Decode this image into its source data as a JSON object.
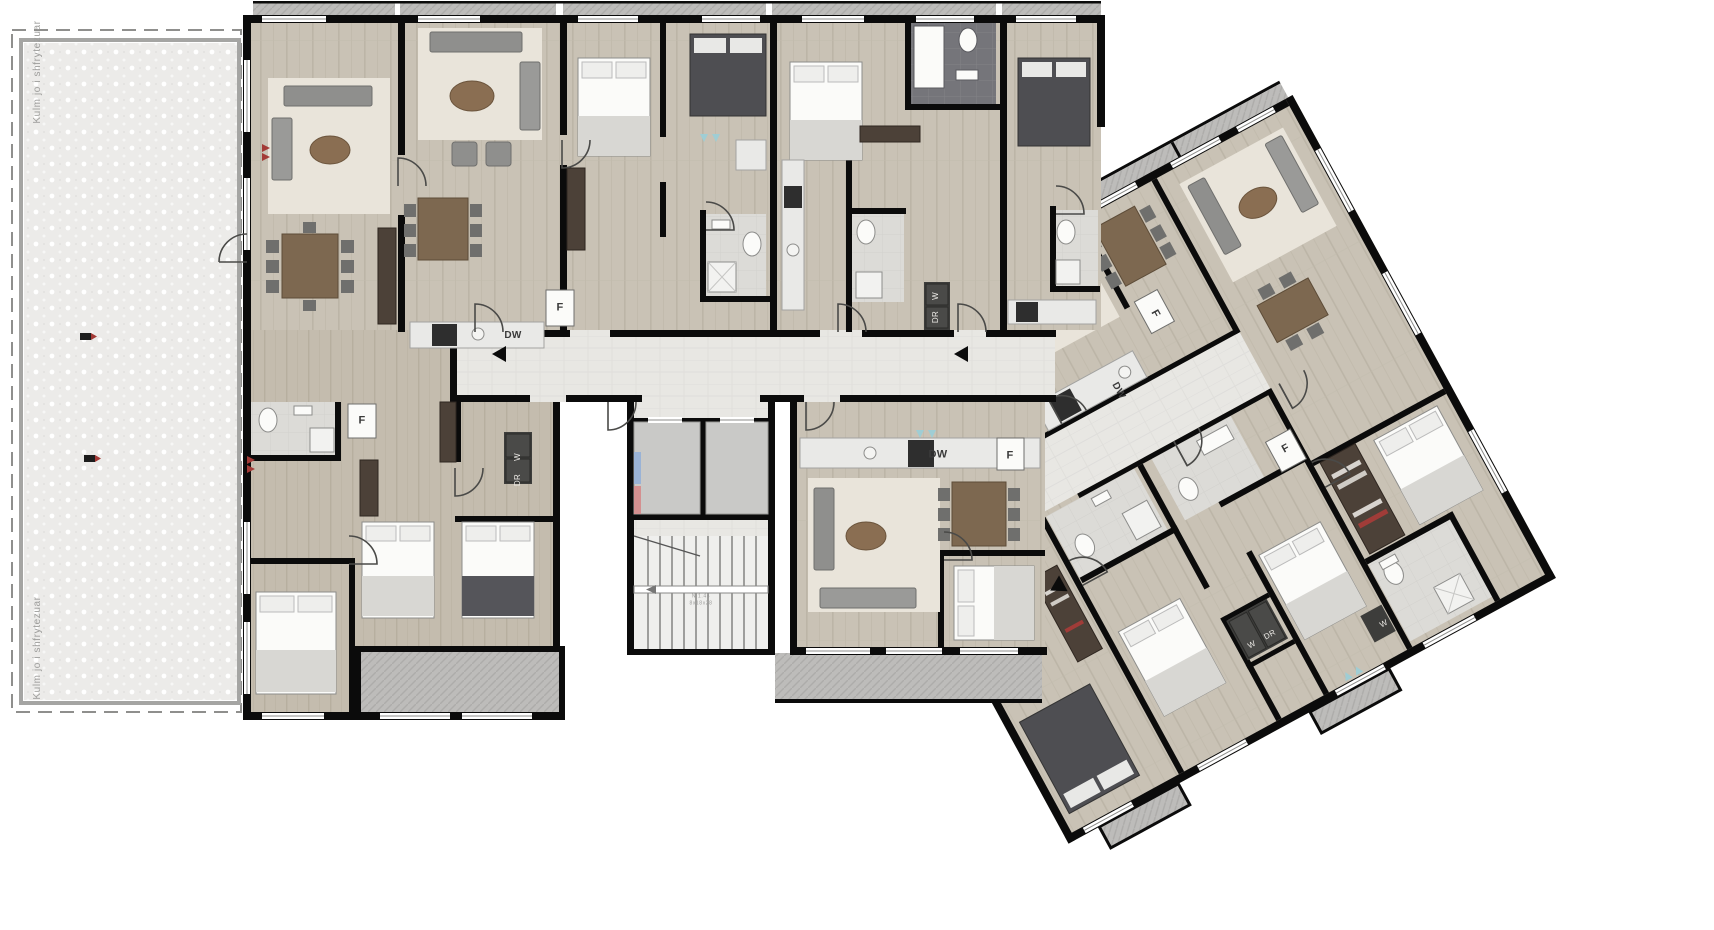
{
  "document": {
    "type": "architectural-floor-plan",
    "view": "furnished apartment level plan"
  },
  "terrace": {
    "label_top": "Kulm jo i shfrytezuar",
    "label_bottom": "Kulm jo i shfrytezuar"
  },
  "stairs": {
    "label_line1": "N 1.44",
    "label_line2": "8x18x28"
  },
  "legend": {
    "fridge": "F",
    "dishwasher": "DW",
    "washer": "W",
    "dryer": "DR"
  },
  "labels": [
    {
      "name": "terrace-label-top",
      "text": "Kulm jo i shfrytezuar",
      "x": 38,
      "y": 72,
      "rot": -90,
      "theme": "gray",
      "size": 10
    },
    {
      "name": "terrace-label-bottom",
      "text": "Kulm jo i shfrytezuar",
      "x": 38,
      "y": 648,
      "rot": -90,
      "theme": "gray",
      "size": 10
    },
    {
      "name": "fridge-label",
      "text": "F",
      "x": 560,
      "y": 308,
      "rot": 0,
      "theme": "",
      "size": 11
    },
    {
      "name": "dishwasher-label",
      "text": "DW",
      "x": 513,
      "y": 336,
      "rot": 0,
      "theme": "",
      "size": 10
    },
    {
      "name": "washer-label",
      "text": "W",
      "x": 936,
      "y": 296,
      "rot": -90,
      "theme": "light",
      "size": 8
    },
    {
      "name": "dryer-label",
      "text": "DR",
      "x": 936,
      "y": 317,
      "rot": -90,
      "theme": "light",
      "size": 8
    },
    {
      "name": "fridge-label",
      "text": "F",
      "x": 362,
      "y": 421,
      "rot": 0,
      "theme": "",
      "size": 11
    },
    {
      "name": "washer-label",
      "text": "W",
      "x": 518,
      "y": 457,
      "rot": -90,
      "theme": "light",
      "size": 8
    },
    {
      "name": "dryer-label",
      "text": "DR",
      "x": 518,
      "y": 480,
      "rot": -90,
      "theme": "light",
      "size": 8
    },
    {
      "name": "dishwasher-label",
      "text": "DW",
      "x": 938,
      "y": 455,
      "rot": 0,
      "theme": "",
      "size": 11
    },
    {
      "name": "fridge-label",
      "text": "F",
      "x": 1010,
      "y": 456,
      "rot": 0,
      "theme": "",
      "size": 11
    },
    {
      "name": "fridge-label",
      "text": "F",
      "x": 1155,
      "y": 314,
      "rot": 61,
      "theme": "",
      "size": 11
    },
    {
      "name": "dishwasher-label",
      "text": "DW",
      "x": 1118,
      "y": 391,
      "rot": 61,
      "theme": "",
      "size": 10
    },
    {
      "name": "fridge-label",
      "text": "F",
      "x": 1286,
      "y": 449,
      "rot": -29,
      "theme": "",
      "size": 11
    },
    {
      "name": "washer-label",
      "text": "W",
      "x": 1252,
      "y": 645,
      "rot": -29,
      "theme": "light",
      "size": 8
    },
    {
      "name": "dryer-label",
      "text": "DR",
      "x": 1270,
      "y": 635,
      "rot": -29,
      "theme": "light",
      "size": 8
    },
    {
      "name": "washer-label",
      "text": "W",
      "x": 1384,
      "y": 624,
      "rot": -29,
      "theme": "light",
      "size": 8
    },
    {
      "name": "stair-label-line1",
      "text": "N 1.44",
      "x": 701,
      "y": 597,
      "rot": 0,
      "theme": "gray",
      "size": 5
    },
    {
      "name": "stair-label-line2",
      "text": "8x18x28",
      "x": 701,
      "y": 604,
      "rot": 0,
      "theme": "gray",
      "size": 5
    }
  ],
  "colors": {
    "wall": "#0b0b0b",
    "wood_floor": "#c9c2b5",
    "corridor_floor": "#e8e7e3",
    "terrace_fill": "#ecebe9",
    "balcony_gray": "#bdbcba",
    "bath_floor": "#dcdbd7",
    "dark_bath": "#75757a",
    "furniture_gray": "#8f8f8d",
    "furniture_dark": "#55555a",
    "wood_table": "#8a6e52",
    "wardrobe": "#4c4138",
    "accent_red": "#a33a36",
    "accent_teal": "#9fcdd4",
    "elevator_blue": "#9ab3d6",
    "elevator_red": "#d49090"
  }
}
